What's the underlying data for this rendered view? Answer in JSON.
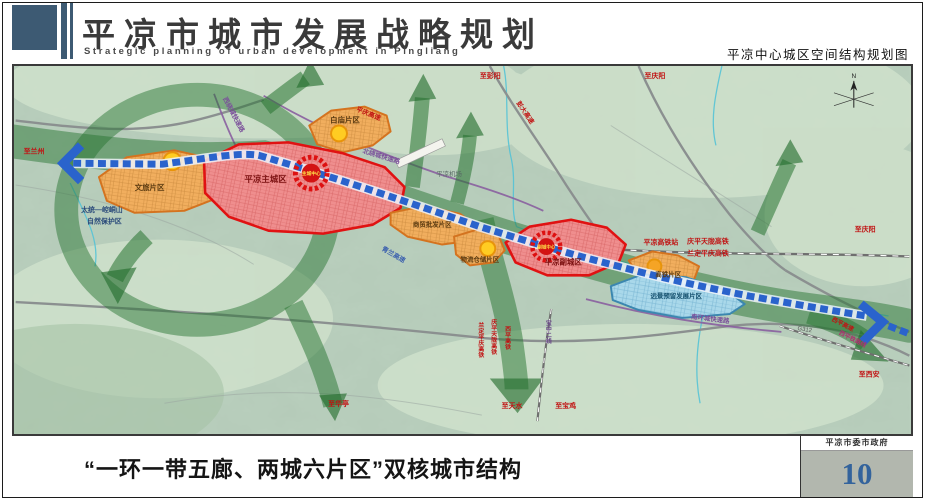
{
  "header": {
    "title": "平凉市城市发展战略规划",
    "subtitle": "Strategic planning of urban development in Pingliang",
    "caption": "平凉中心城区空间结构规划图"
  },
  "map": {
    "zones": {
      "wenlv": "文旅片区",
      "baimiao": "白庙片区",
      "zhucheng": "平凉主城区",
      "shangmao": "商贸批发片区",
      "wuliu": "物流仓储片区",
      "fucheng": "平凉副城区",
      "gaotie": "高铁片区",
      "yuanjing": "远景预留发展片区"
    },
    "centers": {
      "main": "主城中心",
      "sub": "副城中心"
    },
    "labels": {
      "to_lanzhou": "至兰州",
      "to_pengyang": "至彭阳",
      "to_qingyang_top": "至庆阳",
      "to_qingyang_right": "至庆阳",
      "to_xian": "至西安",
      "to_huating": "至华亭",
      "to_tianshui": "至天水",
      "to_baoji": "至宝鸡",
      "pengda_expwy": "彭大高速",
      "pingqing_expwy": "平庆高速",
      "qinglan_expwy": "青兰高速",
      "xiping_expwy": "西平高速",
      "xiping_railway": "西平铁路线",
      "qptl_hsr": "庆平天陇高铁",
      "ldpq_hsr": "兰定平庆高铁",
      "qptl_hsr_v": "庆平天陇高铁",
      "ldpq_hsr_v": "兰定平庆高铁",
      "xiping_hsr_v": "西平高铁",
      "baozhong_line": "宝中二线",
      "north_ring": "北绕城快速路",
      "west_ring": "西绕城快速路",
      "south_ring": "南环城快速路",
      "g312": "G312",
      "airport": "平凉机场",
      "hsr_station": "平凉高铁站",
      "nature_line1": "太统—崆峒山",
      "nature_line2": "自然保护区",
      "compass": "N"
    }
  },
  "footer": {
    "caption": "“一环一带五廊、两城六片区”双核城市结构",
    "org": "平凉市委市政府",
    "page": "10"
  }
}
